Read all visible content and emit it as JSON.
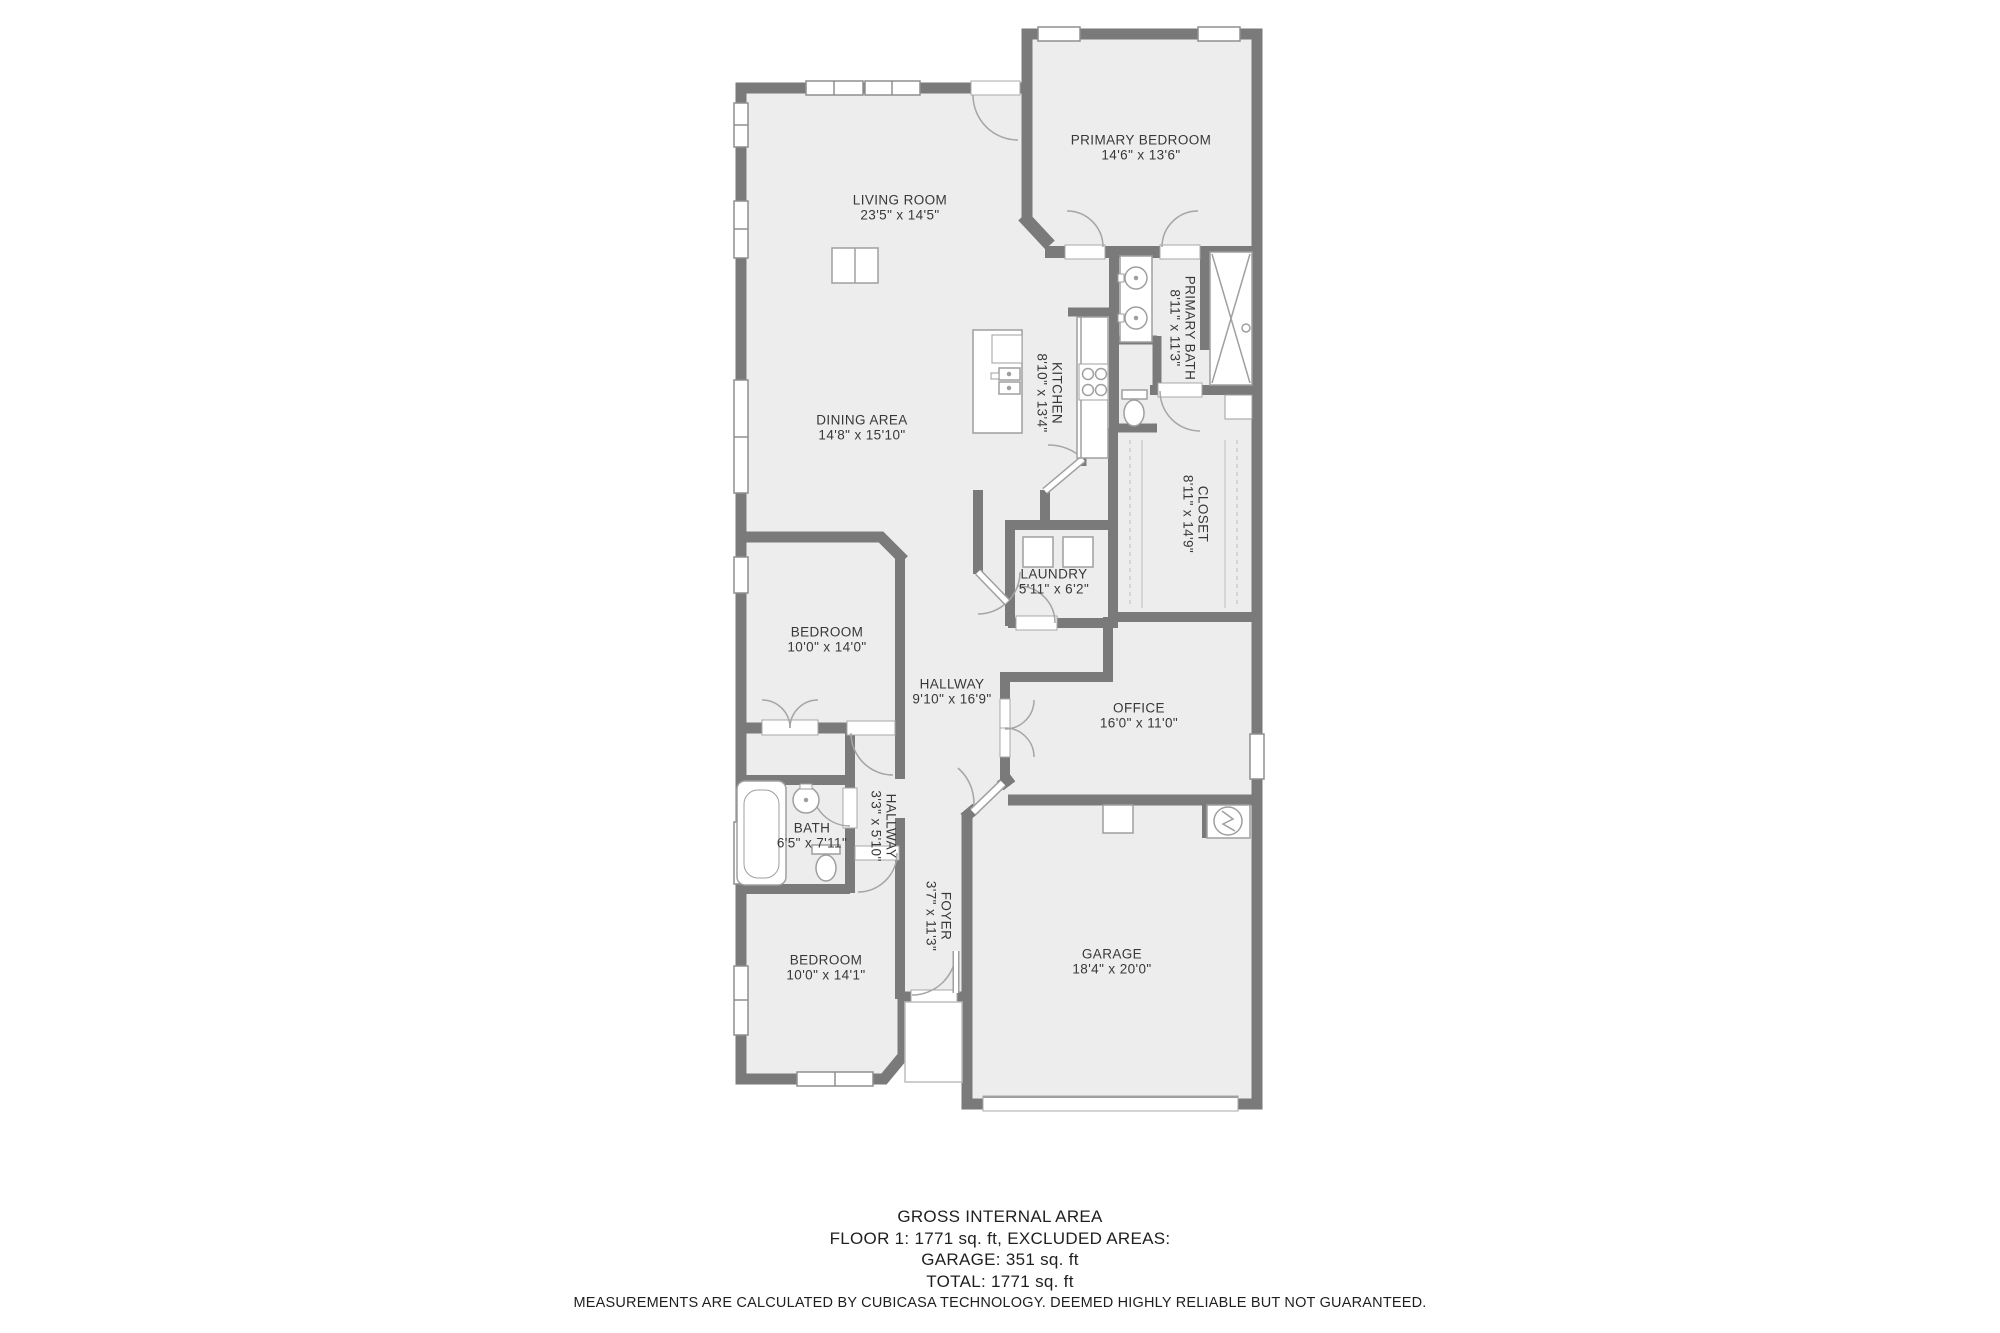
{
  "meta": {
    "type": "floor-plan",
    "floor": "Floor 1"
  },
  "colors": {
    "wall": "#7a7a7a",
    "floor": "#ededed",
    "fixture_stroke": "#9f9f9f",
    "window_stroke": "#8f8f8f",
    "label_text": "#383838",
    "footer_text": "#1f1f1f"
  },
  "rooms": [
    {
      "id": "living-room",
      "lines": [
        "LIVING ROOM",
        "23'5\" x 14'5\""
      ],
      "x": 900,
      "y": 207,
      "rot": false
    },
    {
      "id": "primary-bedroom",
      "lines": [
        "PRIMARY BEDROOM",
        "14'6\" x 13'6\""
      ],
      "x": 1141,
      "y": 147,
      "rot": false
    },
    {
      "id": "primary-bath",
      "lines": [
        "PRIMARY BATH",
        "8'11\" x 11'3\""
      ],
      "x": 1183,
      "y": 328,
      "rot": true
    },
    {
      "id": "kitchen",
      "lines": [
        "KITCHEN",
        "8'10\" x 13'4\""
      ],
      "x": 1050,
      "y": 393,
      "rot": true
    },
    {
      "id": "dining-area",
      "lines": [
        "DINING AREA",
        "14'8\" x 15'10\""
      ],
      "x": 862,
      "y": 427,
      "rot": false
    },
    {
      "id": "closet",
      "lines": [
        "CLOSET",
        "8'11\" x 14'9\""
      ],
      "x": 1196,
      "y": 514,
      "rot": true
    },
    {
      "id": "laundry",
      "lines": [
        "LAUNDRY",
        "5'11\" x 6'2\""
      ],
      "x": 1054,
      "y": 581,
      "rot": false
    },
    {
      "id": "bedroom-upper",
      "lines": [
        "BEDROOM",
        "10'0\" x 14'0\""
      ],
      "x": 827,
      "y": 639,
      "rot": false
    },
    {
      "id": "hallway-main",
      "lines": [
        "HALLWAY",
        "9'10\" x 16'9\""
      ],
      "x": 952,
      "y": 691,
      "rot": false
    },
    {
      "id": "office",
      "lines": [
        "OFFICE",
        "16'0\" x 11'0\""
      ],
      "x": 1139,
      "y": 715,
      "rot": false
    },
    {
      "id": "bath",
      "lines": [
        "BATH",
        "6'5\" x 7'11\""
      ],
      "x": 812,
      "y": 835,
      "rot": false
    },
    {
      "id": "hallway-small",
      "lines": [
        "HALLWAY",
        "3'3\" x 5'10\""
      ],
      "x": 884,
      "y": 826,
      "rot": true
    },
    {
      "id": "foyer",
      "lines": [
        "FOYER",
        "3'7\" x 11'3\""
      ],
      "x": 939,
      "y": 916,
      "rot": true
    },
    {
      "id": "bedroom-lower",
      "lines": [
        "BEDROOM",
        "10'0\" x 14'1\""
      ],
      "x": 826,
      "y": 967,
      "rot": false
    },
    {
      "id": "garage",
      "lines": [
        "GARAGE",
        "18'4\" x 20'0\""
      ],
      "x": 1112,
      "y": 961,
      "rot": false
    }
  ],
  "footer": {
    "line1": "GROSS INTERNAL AREA",
    "line2": "FLOOR 1: 1771 sq. ft, EXCLUDED AREAS:",
    "line3": "GARAGE: 351 sq. ft",
    "line4": "TOTAL: 1771 sq. ft",
    "disclaimer": "MEASUREMENTS ARE CALCULATED BY CUBICASA TECHNOLOGY. DEEMED HIGHLY RELIABLE BUT NOT GUARANTEED."
  }
}
